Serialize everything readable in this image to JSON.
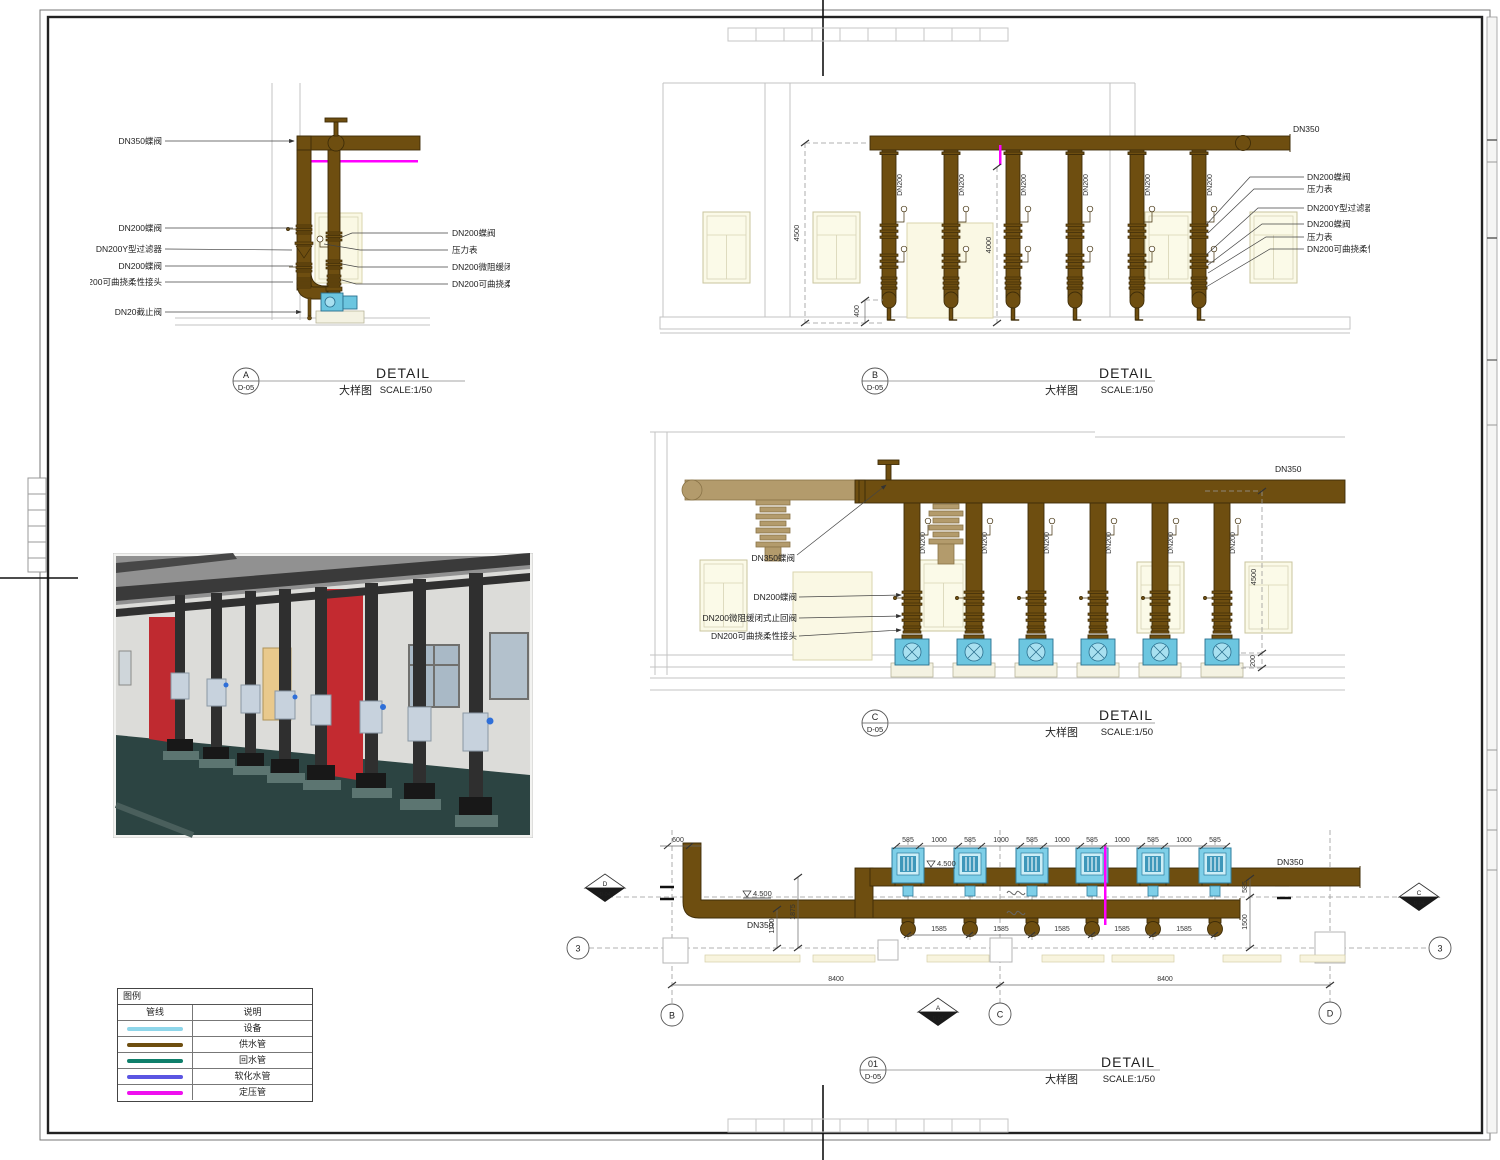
{
  "titles": {
    "detail": "DETAIL",
    "subtitle": "大样图",
    "scale": "SCALE:1/50",
    "sheet_ref": "D-05",
    "section_ref": "D-04"
  },
  "detail_a": {
    "tag": "A",
    "labels_left": [
      "DN350蝶阀",
      "DN200蝶阀",
      "DN200Y型过滤器",
      "DN200蝶阀",
      "DN200可曲挠柔性接头",
      "DN20截止阀"
    ],
    "labels_right": [
      "DN200蝶阀",
      "压力表",
      "DN200微阻缓闭式止回阀",
      "DN200可曲挠柔性接头"
    ]
  },
  "detail_b": {
    "tag": "B",
    "header_label": "DN350",
    "riser_label": "DN200",
    "labels_right": [
      "DN200蝶阀",
      "压力表",
      "DN200Y型过滤器",
      "DN200蝶阀",
      "压力表",
      "DN200可曲挠柔性接头"
    ],
    "dim_height": "4500",
    "dim_mid": "4000",
    "dim_bottom": "400"
  },
  "detail_c": {
    "tag": "C",
    "header_label": "DN350",
    "riser_label": "DN200",
    "labels_left": [
      "DN350蝶阀",
      "DN200蝶阀",
      "DN200微阻缓闭式止回阀",
      "DN200可曲挠柔性接头"
    ],
    "dim_height": "4500",
    "dim_bottom": "200"
  },
  "plan": {
    "tag": "01",
    "header_label": "DN350",
    "branch_label": "DN350",
    "dim_600": "600",
    "dims_top": [
      "585",
      "1000",
      "585",
      "1000",
      "585",
      "1000",
      "585",
      "1000",
      "585",
      "1000",
      "585"
    ],
    "dims_pump_spacing": [
      "1585",
      "1585",
      "1585",
      "1585",
      "1585"
    ],
    "dims_span": [
      "8400",
      "8400"
    ],
    "levels": [
      "4.500",
      "4.500"
    ],
    "dim_a": "1875",
    "dim_b": "1100",
    "dim_c": "585",
    "dim_d": "1500",
    "grids": {
      "row": "3",
      "col_b": "B",
      "col_c": "C",
      "col_d": "D"
    },
    "sections": {
      "left": "D",
      "bottom": "A",
      "right": "C"
    }
  },
  "legend": {
    "title": "图例",
    "col_line": "管线",
    "col_desc": "说明",
    "rows": [
      {
        "color": "#8ed6ea",
        "label": "设备"
      },
      {
        "color": "#6e4e10",
        "label": "供水管"
      },
      {
        "color": "#0f7f6b",
        "label": "回水管"
      },
      {
        "color": "#5b55e2",
        "label": "软化水管"
      },
      {
        "color": "#ef10ef",
        "label": "定压管"
      }
    ]
  }
}
